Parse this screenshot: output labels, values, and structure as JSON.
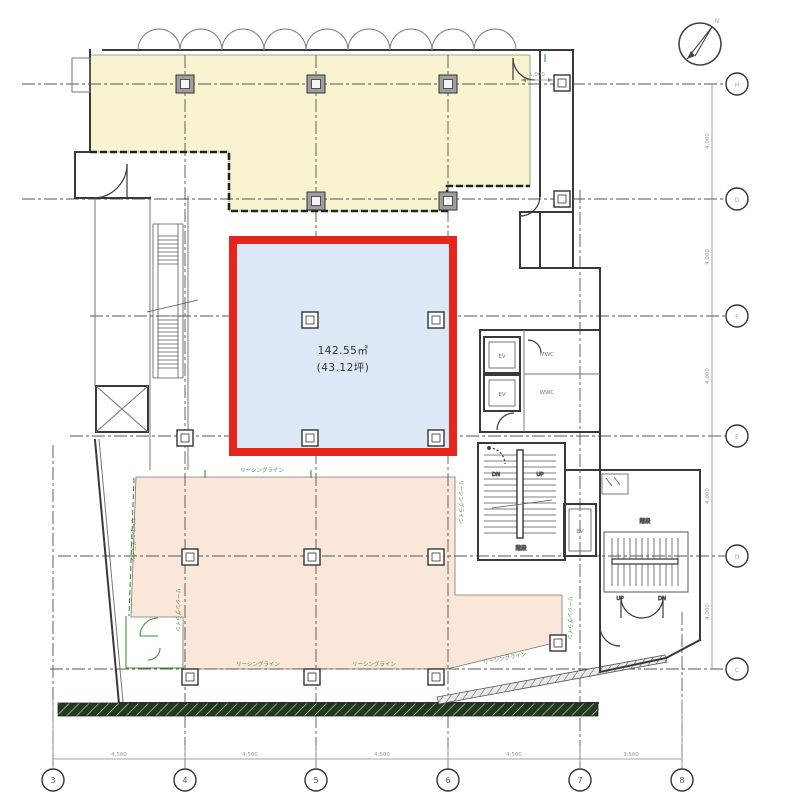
{
  "colors": {
    "yellow": "#f8f4cf",
    "blue": "#dce8f5",
    "pink": "#fbe7da",
    "red": "#e8251d",
    "green": "#3f8f3f",
    "dark_band": "#22381f",
    "wall": "#3a3a3a"
  },
  "area": {
    "line1": "142.55㎡",
    "line2": "(43.12坪)"
  },
  "grid": {
    "bottom_labels": [
      "3",
      "4",
      "5",
      "6",
      "7",
      "8"
    ],
    "right_labels": [
      "H",
      "G",
      "F",
      "E",
      "D",
      "C"
    ],
    "bottom_dims": [
      "4,500",
      "4,500",
      "4,500",
      "4,500",
      "3,500"
    ],
    "right_dims": [
      "4,000",
      "4,000",
      "4,000",
      "4,000",
      "4,000"
    ]
  },
  "labels": {
    "leasing_line": "リーシングライン",
    "stairs": "階段",
    "elevator": "EV",
    "mens_wc": "MWC",
    "womens_wc": "WWC",
    "up": "UP",
    "down": "DN",
    "north": "N",
    "dim_small": "1,000"
  }
}
